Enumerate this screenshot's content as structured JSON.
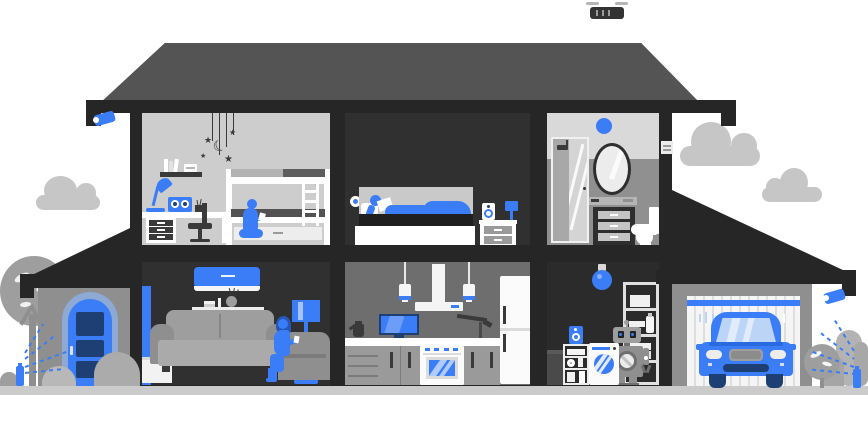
{
  "scene": {
    "name": "smart-home-cutaway",
    "description": "Cross-section illustration of a two-story smart home with connected devices, garage and yard",
    "visible_text": "none"
  },
  "glyphs": {
    "star": "★",
    "moon": "☾"
  },
  "palette": {
    "blue": "#3b7cf7",
    "blue-deep": "#2a6ae0",
    "navy": "#1e3f73",
    "sky-blue": "#bcd4f5",
    "peri": "#8ea9d4",
    "ink": "#262626",
    "room-dark": "#303030",
    "roof": "#545454",
    "wall-gray": "#8f8f8f",
    "kitchen-wall": "#6e6e6e",
    "room-light": "#cdcdcd",
    "bath-upper": "#d9d9d9",
    "bath-lower": "#909090",
    "gray": "#9e9e9e",
    "gray-light": "#c6c6c6",
    "ground": "#cbcbcb",
    "paper": "#f5f5f5",
    "fixture": "#3a3a3a"
  },
  "house": {
    "upper_floor": [
      {
        "id": "kids-room",
        "objects": [
          "hanging star-and-moon mobile",
          "wall shelf with books",
          "blue desk lamp",
          "smart radio speaker",
          "white desk with drawers",
          "office chair",
          "bunk bed with ladder",
          "child sitting with tablet"
        ]
      },
      {
        "id": "bedroom",
        "objects": [
          "wall smart sensor",
          "bed",
          "person reading under blue blanket",
          "nightstand",
          "smart speaker",
          "blue lamp"
        ]
      },
      {
        "id": "bathroom",
        "objects": [
          "blue smart ceiling light",
          "shower cabin",
          "oval mirror",
          "vanity cabinet",
          "toilet"
        ]
      }
    ],
    "lower_floor": [
      {
        "id": "living-room",
        "objects": [
          "blue air conditioner",
          "wall shelf with vase and books",
          "sofa",
          "woman on armchair with phone",
          "blue floor lamp",
          "smart sensor",
          "blue curtain",
          "white cabinet"
        ]
      },
      {
        "id": "kitchen",
        "objects": [
          "two pendant lights",
          "range hood",
          "tv on counter",
          "coffee kettle",
          "faucet",
          "oven-stove",
          "fridge",
          "gray cabinets"
        ]
      },
      {
        "id": "utility-room",
        "objects": [
          "blue pendant bulb",
          "storage shelving",
          "robot assistant",
          "washing machine",
          "smart speaker",
          "supply shelf",
          "trash bin"
        ]
      }
    ],
    "garage": {
      "objects": [
        "sloped roof",
        "security camera",
        "garage door with blue stripe",
        "blue car",
        "round bush",
        "shrubs",
        "smart sprinkler"
      ]
    },
    "porch": {
      "objects": [
        "sloped roof",
        "blue arched front door",
        "tree",
        "bushes",
        "smart sprinkler"
      ]
    }
  },
  "exterior": {
    "objects": [
      "left security camera",
      "delivery drone",
      "three clouds",
      "ground strip"
    ]
  }
}
